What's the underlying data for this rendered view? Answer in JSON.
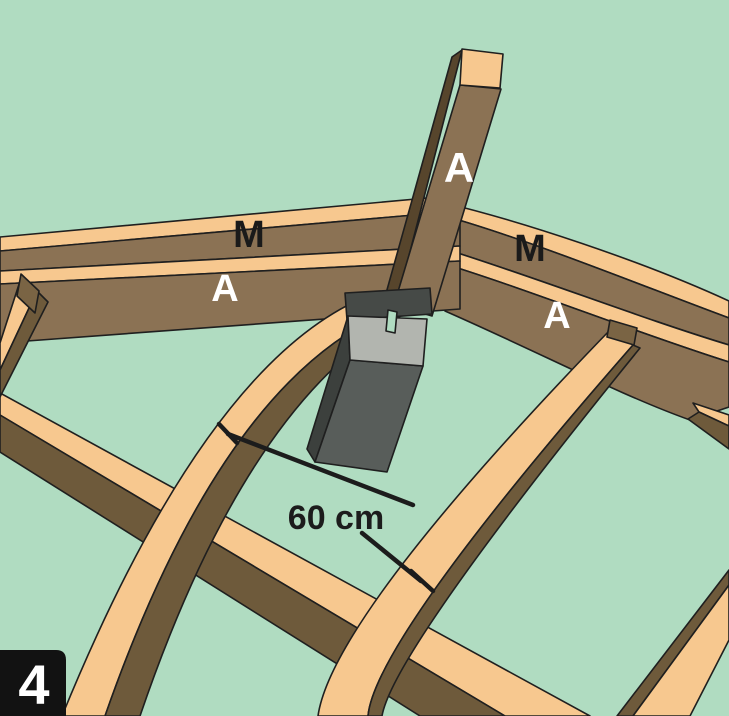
{
  "figure": {
    "type": "construction-step-illustration",
    "step_number": "4",
    "dimension_label": "60 cm",
    "labels": {
      "left_beam_top": "M",
      "left_beam_front": "A",
      "right_beam_top": "M",
      "right_beam_front": "A",
      "post": "A"
    },
    "palette": {
      "background": "#b0dcc1",
      "wood_light": "#f7c88f",
      "wood_medium": "#8b7254",
      "wood_dark": "#6e5a3b",
      "wood_darkest": "#57452c",
      "wood_butt": "#7a6444",
      "concrete_top": "#b2b5af",
      "concrete_front": "#585d5a",
      "concrete_side": "#3c403d",
      "bracket": "#464a47",
      "outline": "#1f1f1f",
      "annotation": "#1c1c1c",
      "label_dark": "#1a1a1a",
      "label_light": "#ffffff",
      "badge_background": "#121212",
      "badge_text": "#ffffff"
    }
  }
}
